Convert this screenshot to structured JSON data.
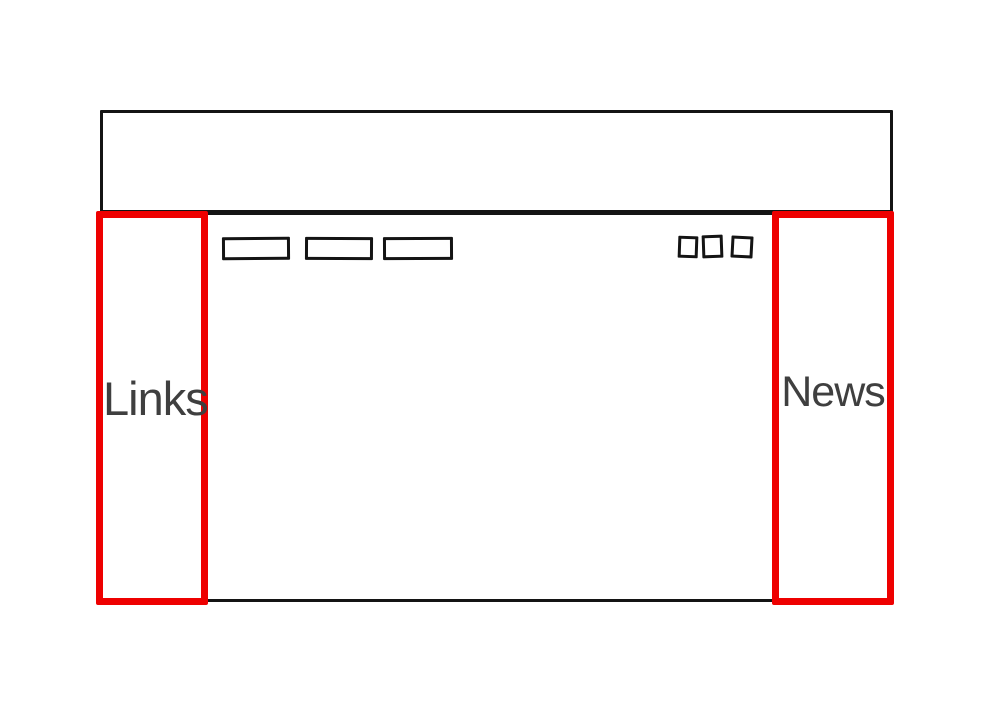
{
  "colors": {
    "sketch_line": "#141414",
    "highlight_red": "#ee0000",
    "label_text": "#3f3f3f",
    "background": "#ffffff"
  },
  "wireframe": {
    "left_sidebar": {
      "label": "Links"
    },
    "right_sidebar": {
      "label": "News"
    },
    "nav_button_placeholders": {
      "count": 3
    },
    "icon_square_placeholders": {
      "count": 3
    }
  }
}
